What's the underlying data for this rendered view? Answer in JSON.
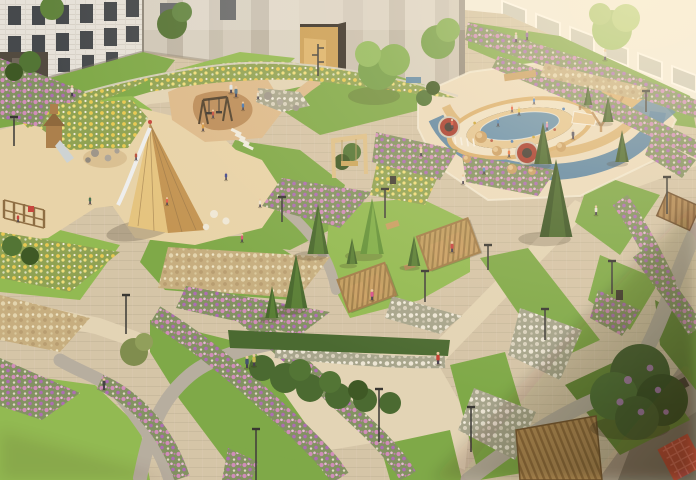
{
  "meta": {
    "title": "Aerial rendering of a landscaped residential courtyard with playgrounds at golden hour",
    "type": "architectural visualization",
    "view": "aerial oblique",
    "time_of_day": "golden hour"
  },
  "palette": {
    "pavement": "#d3c4a8",
    "pavementLight": "#e2d4b7",
    "pavementShade": "#a2968a",
    "gravel": "#b4aca0",
    "grass": "#79a744",
    "grassBright": "#8db94e",
    "grassShade": "#5d8334",
    "sand": "#e7d3a9",
    "sandWarm": "#dcb98b",
    "sandBlob": "#b98a57",
    "rubberCream": "#ecdcbf",
    "rubberBlue": "#507ea3",
    "rubberTan": "#d8ae6e",
    "wood": "#c79c5f",
    "woodLight": "#ddc089",
    "woodDark": "#8a6a40",
    "pineDark": "#33501f",
    "pineMid": "#3f6328",
    "pineBright": "#5d8f35",
    "bush": "#42652c",
    "flowerPink": "#cf8abc",
    "flowerPurple": "#a968b5",
    "flowerYellow": "#e7c94e",
    "flowerWhite": "#ece7d8",
    "plumeTan": "#d9cba3",
    "building": "#e7e4de",
    "buildingBright": "#f2efe8",
    "stripe1": "#cdc7ba",
    "stripe2": "#bbb4a7",
    "windowGlass": "#3d4248",
    "portalGold": "#c99c52",
    "accentRed": "#b43a2c",
    "trampolineRed": "#a33226",
    "skin": "#e9c7a0",
    "shadow": "#2e2417"
  },
  "scene": {
    "buildings": [
      {
        "label": "brick apartment building top-left"
      },
      {
        "label": "striped concrete facade with golden entrance portal"
      },
      {
        "label": "sunlit white apartment building top-right"
      },
      {
        "label": "shaded building corner with red balcony grilles bottom-right"
      },
      {
        "label": "white balcony stack bottom-left"
      }
    ],
    "playgrounds": [
      {
        "label": "sand playground with wooden teepee and slide"
      },
      {
        "label": "toddler sand playground with play tower and slide"
      },
      {
        "label": "swing playground on tan rubber pad"
      },
      {
        "label": "oval climbing structure playground with blue rubber swirls, trampolines and mounds"
      }
    ],
    "amenities": [
      "wooden pergola lounges",
      "portal swing frame",
      "wooden decks",
      "benches",
      "stone stepping pads"
    ],
    "vegetation": [
      "pink petunia bands",
      "yellow flower meadows",
      "ornamental grass plumes",
      "spruce trees",
      "clipped hedges",
      "lilac tree"
    ],
    "conifers": [
      [
        318,
        254,
        50,
        "mid"
      ],
      [
        296,
        308,
        54,
        "mid"
      ],
      [
        372,
        254,
        56,
        "bright"
      ],
      [
        272,
        318,
        32,
        "mid"
      ],
      [
        556,
        237,
        78,
        "dark"
      ],
      [
        543,
        164,
        42,
        "dark"
      ],
      [
        414,
        266,
        30,
        "mid"
      ],
      [
        608,
        122,
        26,
        "dark"
      ],
      [
        622,
        162,
        32,
        "dark"
      ],
      [
        352,
        264,
        26,
        "mid"
      ],
      [
        588,
        105,
        20,
        "dark"
      ]
    ],
    "lamps": [
      [
        126,
        296,
        38,
        "arm"
      ],
      [
        385,
        190,
        28,
        "arm"
      ],
      [
        425,
        272,
        30,
        "arm"
      ],
      [
        488,
        246,
        24,
        "arm"
      ],
      [
        545,
        310,
        30,
        "arm"
      ],
      [
        612,
        262,
        32,
        "arm"
      ],
      [
        667,
        178,
        36,
        "arm"
      ],
      [
        646,
        92,
        20,
        "arm"
      ],
      [
        256,
        430,
        50,
        "arm"
      ],
      [
        14,
        118,
        28,
        "arm"
      ],
      [
        282,
        198,
        24,
        "arm"
      ],
      [
        104,
        378,
        12,
        "bollard"
      ],
      [
        318,
        44,
        32,
        "multi"
      ],
      [
        471,
        408,
        44,
        "arm"
      ],
      [
        379,
        390,
        52,
        "arm"
      ]
    ],
    "trampolines": [
      [
        449,
        127,
        9
      ],
      [
        527,
        153,
        10
      ]
    ],
    "domes": [
      [
        481,
        137,
        6
      ],
      [
        497,
        151,
        5
      ],
      [
        467,
        159,
        4
      ],
      [
        543,
        154,
        6
      ],
      [
        561,
        147,
        5
      ],
      [
        512,
        169,
        5
      ],
      [
        532,
        171,
        4
      ]
    ],
    "people": [
      [
        231,
        93,
        "#dfe6ea",
        0.9
      ],
      [
        236,
        97,
        "#49708c",
        0.9
      ],
      [
        72,
        96,
        "#e8e2d4",
        0.9
      ],
      [
        213,
        118,
        "#c24a3c",
        0.7
      ],
      [
        243,
        110,
        "#3f74b4",
        0.7
      ],
      [
        258,
        99,
        "#e4dbc6",
        0.7
      ],
      [
        203,
        131,
        "#d9993c",
        0.7
      ],
      [
        226,
        180,
        "#3c4490",
        0.7
      ],
      [
        242,
        242,
        "#d8506e",
        0.7
      ],
      [
        260,
        207,
        "#ece2d0",
        0.7
      ],
      [
        136,
        160,
        "#b44c38",
        0.7
      ],
      [
        90,
        204,
        "#3f6f4d",
        0.7
      ],
      [
        18,
        222,
        "#c43f38",
        0.7
      ],
      [
        452,
        128,
        "#d84a38",
        0.75
      ],
      [
        498,
        126,
        "#3d7cb8",
        0.7
      ],
      [
        519,
        115,
        "#e6c648",
        0.7
      ],
      [
        547,
        130,
        "#d88cba",
        0.7
      ],
      [
        573,
        139,
        "#4c4c5e",
        0.8
      ],
      [
        509,
        157,
        "#e8703c",
        0.7
      ],
      [
        484,
        174,
        "#5c8cc8",
        0.7
      ],
      [
        463,
        184,
        "#eae2d8",
        0.8
      ],
      [
        516,
        42,
        "#d8d0c6",
        0.8
      ],
      [
        527,
        40,
        "#8a5c9c",
        0.8
      ],
      [
        605,
        60,
        "#eae4da",
        0.9
      ],
      [
        247,
        368,
        "#3c4c6c",
        1
      ],
      [
        254,
        366,
        "#c9ba4e",
        1
      ],
      [
        438,
        364,
        "#c2392e",
        1
      ],
      [
        372,
        300,
        "#d84c8c",
        0.9
      ],
      [
        452,
        252,
        "#c43c3c",
        0.9
      ],
      [
        104,
        389,
        "#3c3c40",
        0.9
      ],
      [
        596,
        215,
        "#e9e5dc",
        0.8
      ],
      [
        421,
        156,
        "#ead2b2",
        0.8
      ],
      [
        512,
        112,
        "#e85a3a",
        0.6
      ],
      [
        534,
        104,
        "#4a8ad8",
        0.6
      ],
      [
        167,
        205,
        "#e85a4a",
        0.65
      ]
    ]
  }
}
